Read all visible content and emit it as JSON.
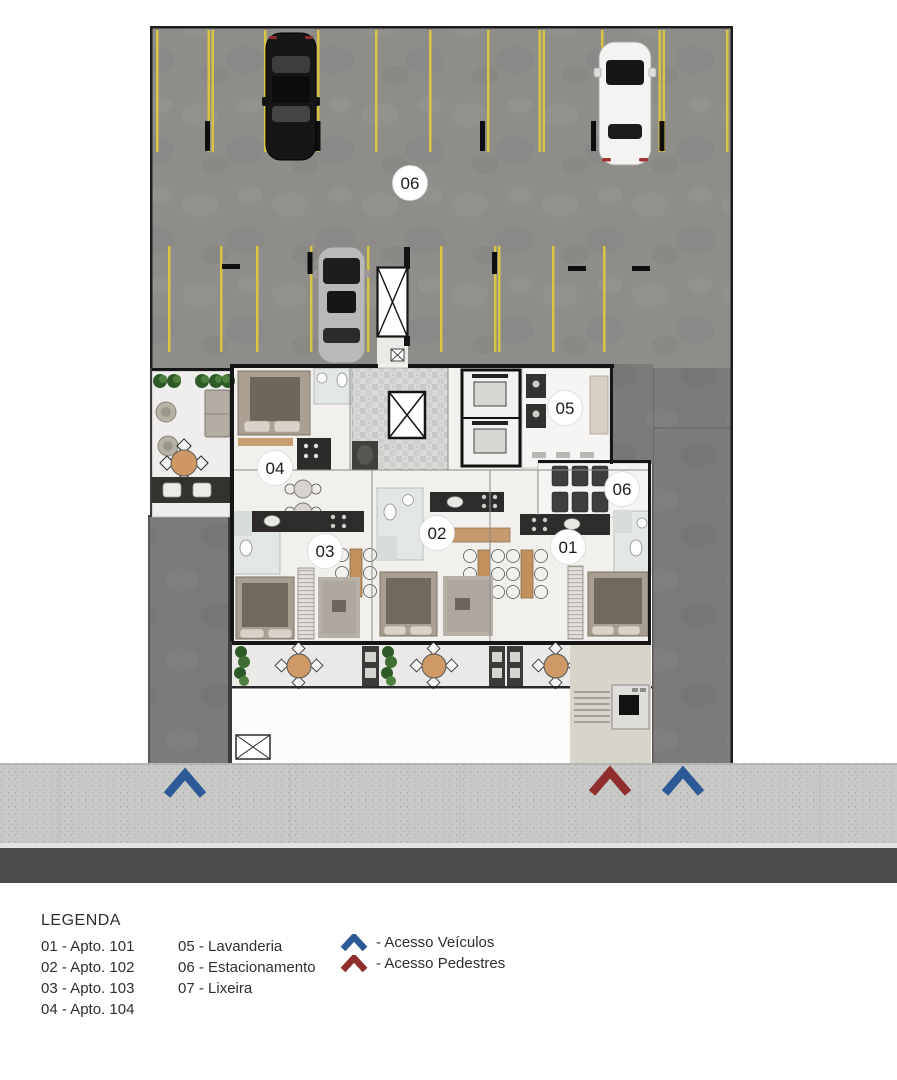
{
  "floor_plan": {
    "unit_markers": [
      "06",
      "04",
      "05",
      "06",
      "03",
      "02",
      "01"
    ]
  },
  "legend": {
    "title": "LEGENDA",
    "column1": [
      "01 - Apto. 101",
      "02 - Apto. 102",
      "03 - Apto. 103",
      "04 - Apto. 104"
    ],
    "column2": [
      "05 - Lavanderia",
      "06 - Estacionamento",
      "07 - Lixeira"
    ],
    "access": [
      {
        "icon": "chevron-arrow-icon",
        "color": "#2d5a96",
        "label": "- Acesso Veículos"
      },
      {
        "icon": "chevron-arrow-icon",
        "color": "#8e2f2d",
        "label": "- Acesso Pedestres"
      }
    ]
  },
  "colors": {
    "parking_line_yellow": "#d9c53f",
    "vehicle_access_blue": "#2d5a96",
    "pedestrian_access_red": "#8e2f2d"
  }
}
